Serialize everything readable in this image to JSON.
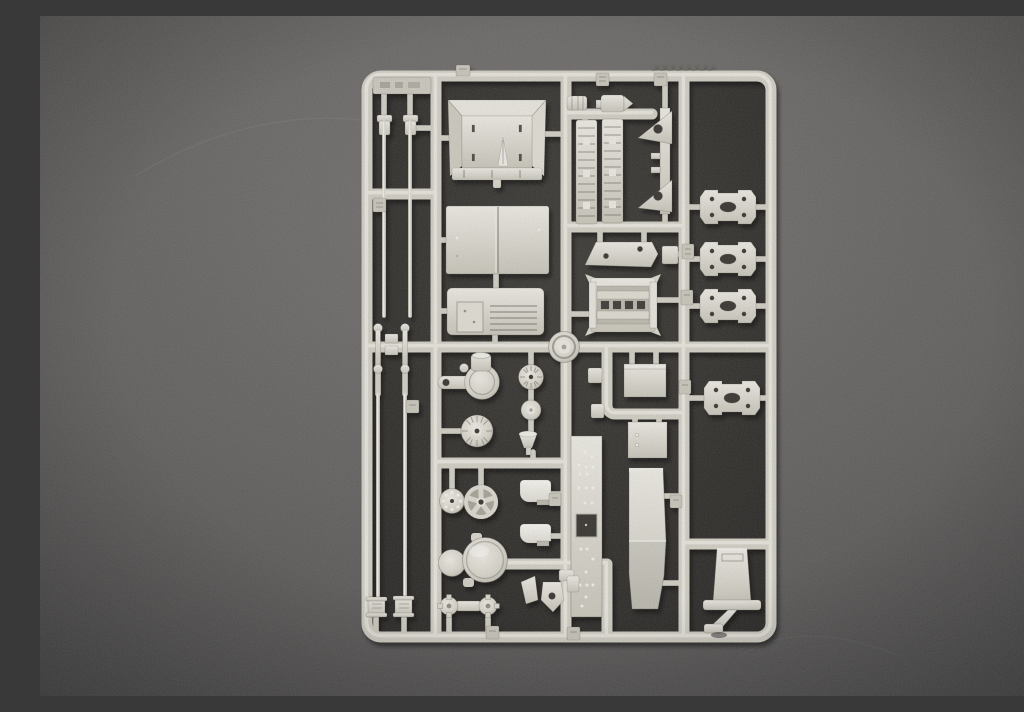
{
  "scene": {
    "kind": "photograph",
    "description": "Overhead photograph of a light grey injection-moulded plastic model kit sprue (parts frame) lying on a dark grey speckled surface",
    "visible_text": "none legible; only faint embossed part-number tags on the runners"
  },
  "colors": {
    "background": "#676563",
    "mat": "#2c2a27",
    "plastic_base": "#cfccc2",
    "plastic_highlight": "#e9e7e0",
    "plastic_shadow": "#9f9c91",
    "part_face": "#d7d4ca",
    "part_bright": "#f2f1eb",
    "hole_dark": "#34322e"
  },
  "sprue": {
    "frame": "rounded rectangular outer runner with three internal vertical runners and several horizontal cross runners",
    "parts": [
      {
        "name": "rod-end-fitting",
        "qty": 2
      },
      {
        "name": "long-thin-rod",
        "qty": 4
      },
      {
        "name": "tie-rod-link",
        "qty": 2
      },
      {
        "name": "ribbed-end-cylinder",
        "qty": 2
      },
      {
        "name": "flared-box-panel",
        "qty": 1
      },
      {
        "name": "roof-panel",
        "qty": 1
      },
      {
        "name": "louvered-hatch-panel",
        "qty": 1
      },
      {
        "name": "ribbed-muffler-drum",
        "qty": 1
      },
      {
        "name": "bullet-cylinder",
        "qty": 1
      },
      {
        "name": "serrated-ladder-strip",
        "qty": 2
      },
      {
        "name": "triangular-bracket-mount",
        "qty": 1
      },
      {
        "name": "drilled-angle-bracket",
        "qty": 1
      },
      {
        "name": "slatted-frame-mount",
        "qty": 1
      },
      {
        "name": "axle-mounting-plate",
        "qty": 4
      },
      {
        "name": "concentric-ring-cap",
        "qty": 1
      },
      {
        "name": "final-drive-housing",
        "qty": 1
      },
      {
        "name": "radial-ribbed-disc",
        "qty": 1
      },
      {
        "name": "hub-disc",
        "qty": 1
      },
      {
        "name": "funnel-cone",
        "qty": 1
      },
      {
        "name": "ribbed-cog-wheel",
        "qty": 1
      },
      {
        "name": "bolted-flange-disc",
        "qty": 1
      },
      {
        "name": "five-spoke-wheel",
        "qty": 1
      },
      {
        "name": "smooth-drum-cylinder",
        "qty": 1
      },
      {
        "name": "idler-disc",
        "qty": 1
      },
      {
        "name": "axle-with-flanged-hubs",
        "qty": 1
      },
      {
        "name": "rounded-stowage-box",
        "qty": 2
      },
      {
        "name": "riveted-stowage-box",
        "qty": 2
      },
      {
        "name": "riveted-side-plate",
        "qty": 1
      },
      {
        "name": "smooth-fender-plate",
        "qty": 1
      },
      {
        "name": "seat-with-frame",
        "qty": 1
      },
      {
        "name": "knuckle-bracket-cluster",
        "qty": 1
      },
      {
        "name": "part-number-tag",
        "qty": 12
      }
    ]
  }
}
